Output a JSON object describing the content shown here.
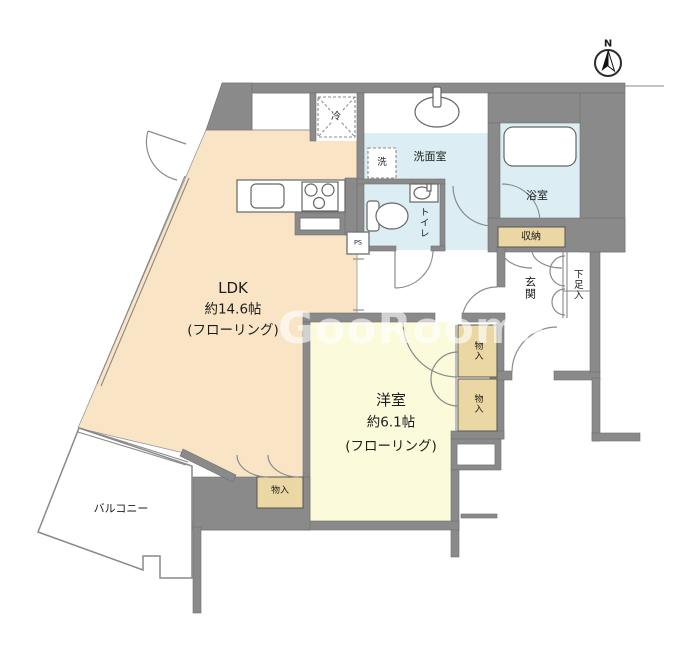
{
  "watermark": "GooRooms",
  "compass": {
    "north_label": "N"
  },
  "rooms": {
    "ldk": {
      "name": "LDK",
      "size": "約14.6帖",
      "floor": "(フローリング)"
    },
    "bedroom": {
      "name": "洋室",
      "size": "約6.1帖",
      "floor": "(フローリング)"
    },
    "washroom": {
      "name": "洗面室"
    },
    "bathroom": {
      "name": "浴室"
    },
    "toilet": {
      "name": "トイレ"
    },
    "entrance": {
      "name": "玄関"
    },
    "shoe_cabinet": {
      "name": "下足入"
    },
    "storage": {
      "name": "収納"
    },
    "closet_upper": {
      "name": "物入"
    },
    "closet_lower": {
      "name": "物入"
    },
    "closet_ldk": {
      "name": "物入"
    },
    "balcony": {
      "name": "バルコニー"
    }
  },
  "fixtures": {
    "refrigerator": {
      "label": "冷"
    },
    "washer": {
      "label": "洗"
    },
    "pipe_space": {
      "label": "PS"
    }
  },
  "colors": {
    "wall": "#8a8a8a",
    "ldk_floor": "#f9e5c5",
    "bedroom_floor": "#fbfada",
    "wet_floor": "#dceef4",
    "closet": "#ebd7a4"
  }
}
